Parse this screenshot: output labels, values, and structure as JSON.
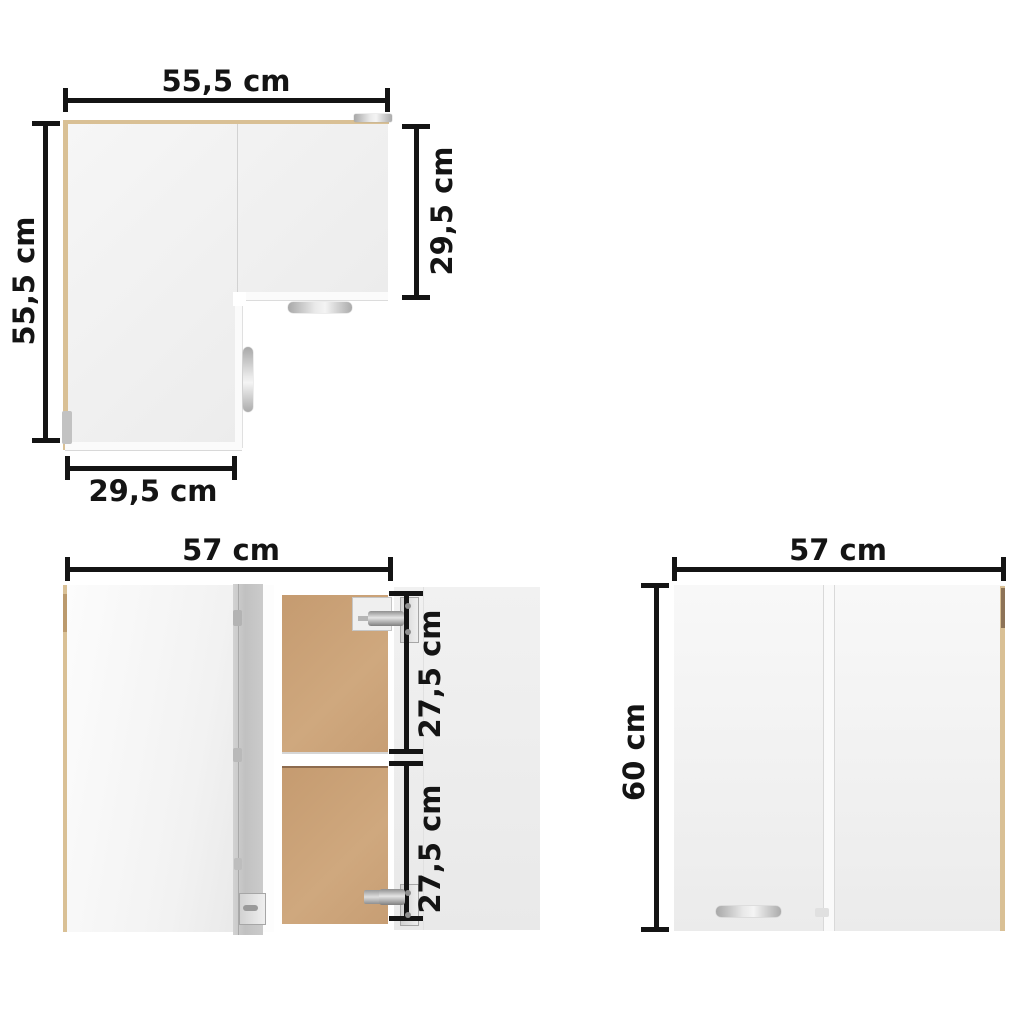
{
  "colors": {
    "dimension_ink": "#141414",
    "wood_edge": "#d9c095",
    "wood_edge_dark": "#8d7357",
    "interior_back_panel": "#c89f76",
    "metal_gray": "#c2c2c2",
    "cabinet_face": "#efefef"
  },
  "views": {
    "top_view": {
      "dim_width_top": "55,5 cm",
      "dim_height_left": "55,5 cm",
      "dim_depth_right": "29,5 cm",
      "dim_width_bottom": "29,5 cm"
    },
    "open_front_view": {
      "dim_width_top": "57 cm",
      "dim_upper_compartment": "27,5 cm",
      "dim_lower_compartment": "27,5 cm"
    },
    "closed_front_view": {
      "dim_width_top": "57 cm",
      "dim_height_left": "60 cm"
    }
  }
}
